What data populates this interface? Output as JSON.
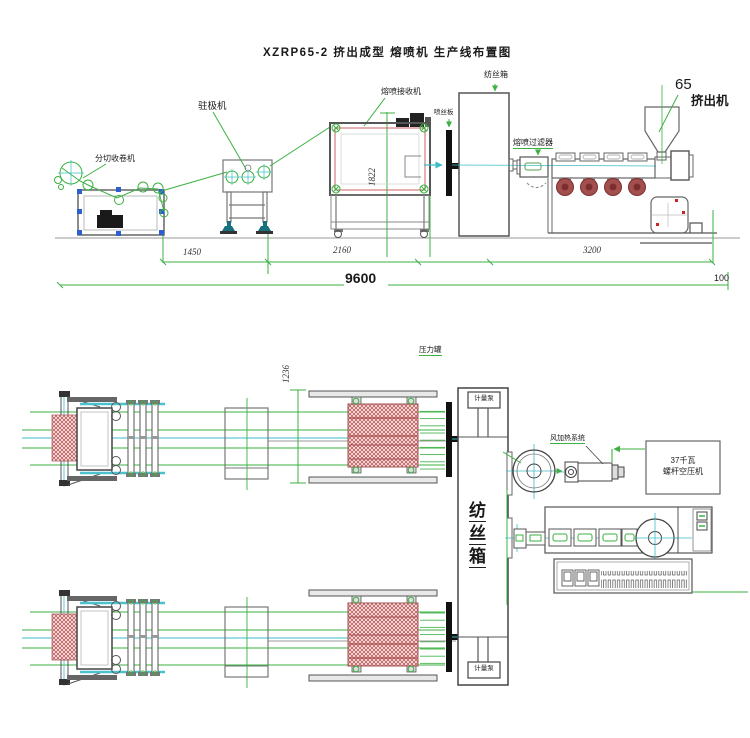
{
  "title": "XZRP65-2 挤出成型 熔喷机 生产线布置图",
  "colors": {
    "line_green": "#3cb043",
    "line_cyan": "#3bbdc8",
    "hatch_red": "#c05e5e",
    "outline_gray": "#555555",
    "accent_blue": "#2e5fd0",
    "fan_red": "#a34f4f"
  },
  "side_view": {
    "labels": {
      "slitting_winder": "分切收卷机",
      "electret_machine": "驻极机",
      "meltblown_receiver": "熔喷接收机",
      "spinneret_plate": "喷丝板",
      "spinning_box": "纺丝箱",
      "meltblown_filter": "熔喷过滤器",
      "extruder_size": "65",
      "extruder": "挤出机"
    },
    "dimensions": {
      "d1450": "1450",
      "d2160": "2160",
      "d3200": "3200",
      "d9600": "9600",
      "d100": "100",
      "h1822": "1822"
    }
  },
  "plan_view": {
    "labels": {
      "pressure_tank": "压力罐",
      "metering_pump_top": "计量泵",
      "metering_pump_bottom": "计量泵",
      "spinning_box": "纺丝箱",
      "air_heating_system": "风加热系统",
      "compressor_line1": "37千瓦",
      "compressor_line2": "螺杆空压机"
    },
    "dimensions": {
      "h1236": "1236"
    }
  }
}
